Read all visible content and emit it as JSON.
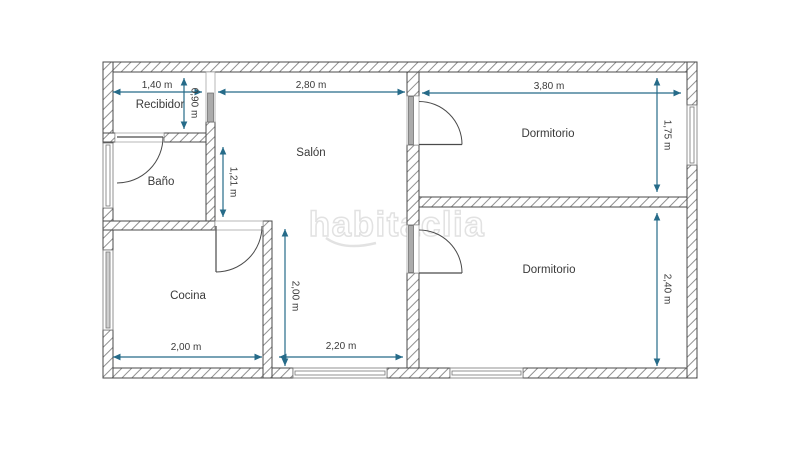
{
  "watermark": {
    "text": "habitaclia",
    "color": "#e2e2e2"
  },
  "colors": {
    "dimension_line": "#266b89",
    "wall_line": "#4a4a4a",
    "hatch": "#909090",
    "text": "#3a3a3a",
    "background": "#ffffff"
  },
  "rooms": {
    "recibidor": {
      "label": "Recibidor",
      "width": "1,40 m",
      "depth": "0,90 m"
    },
    "bano": {
      "label": "Baño"
    },
    "salon": {
      "label": "Salón",
      "width": "2,80 m",
      "upper_depth": "1,21 m",
      "lower_depth": "2,00 m",
      "lower_width": "2,20 m"
    },
    "cocina": {
      "label": "Cocina",
      "width": "2,00 m"
    },
    "dormitorio_1": {
      "label": "Dormitorio",
      "width": "3,80 m",
      "depth": "1,75 m"
    },
    "dormitorio_2": {
      "label": "Dormitorio",
      "depth": "2,40 m"
    }
  }
}
